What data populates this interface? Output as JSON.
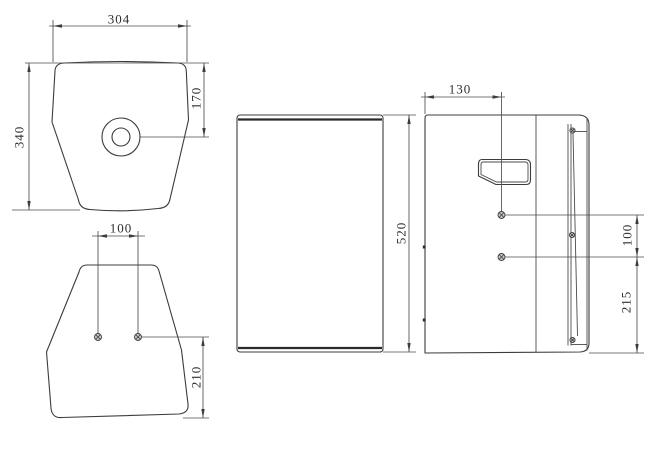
{
  "drawing": {
    "type": "three-view-technical-drawing",
    "subject": "trapezoidal speaker enclosure",
    "background_color": "#ffffff",
    "line_color": "#3c3c3c",
    "views": {
      "top_view": {
        "dims": {
          "overall_width": "304",
          "overall_depth": "340",
          "socket_from_front": "170"
        }
      },
      "bottom_view": {
        "dims": {
          "insert_spacing": "100",
          "insert_from_back": "210"
        }
      },
      "front_view": {
        "dims": {
          "overall_height": "520"
        }
      },
      "side_view": {
        "dims": {
          "handle_from_back": "130",
          "insert_spacing": "100",
          "insert_from_bottom": "215"
        }
      }
    }
  }
}
